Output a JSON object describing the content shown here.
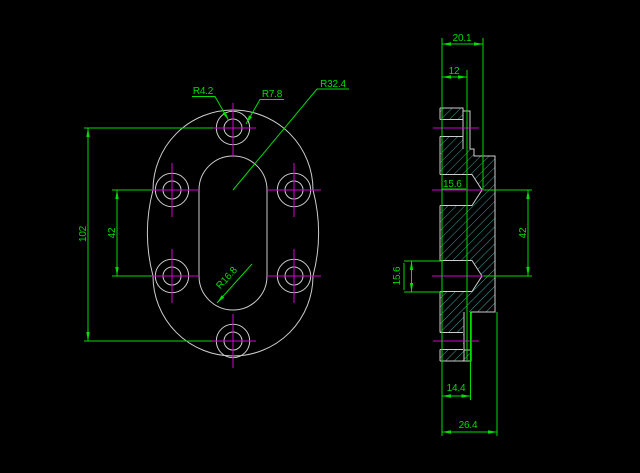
{
  "app": {
    "background": "#000000"
  },
  "colors": {
    "outline": "#cdcdcd",
    "hatch": "#3aa0a0",
    "dimension": "#00dd00",
    "centerline": "#d400d4"
  },
  "front_view": {
    "dims": {
      "overall_height": "102",
      "hole_spacing": "42",
      "bolt_hole_radius": "R4.2",
      "boss_radius": "R7.8",
      "outer_radius": "R32.4",
      "slot_radius": "R16.8"
    }
  },
  "section_view": {
    "dims": {
      "hub_depth": "20.1",
      "plate_thickness": "12",
      "upper_bore_dia": "15.6",
      "lower_bore_dia": "15.6",
      "bore_spacing": "42",
      "boss_depth": "14.4",
      "total_depth": "26.4"
    }
  }
}
